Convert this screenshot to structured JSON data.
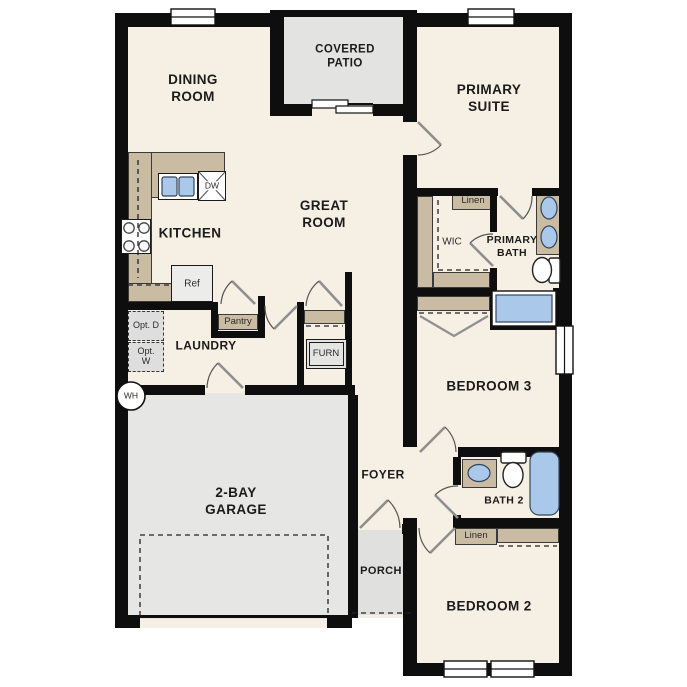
{
  "plan": {
    "rooms": {
      "dining_room": "DINING ROOM",
      "covered_patio": "COVERED PATIO",
      "primary_suite": "PRIMARY SUITE",
      "kitchen": "KITCHEN",
      "great_room": "GREAT ROOM",
      "laundry": "LAUNDRY",
      "garage": "2-BAY GARAGE",
      "foyer": "FOYER",
      "porch": "PORCH",
      "wic": "WIC",
      "primary_bath": "PRIMARY BATH",
      "bedroom_3": "BEDROOM 3",
      "bath_2": "BATH 2",
      "bedroom_2": "BEDROOM 2"
    },
    "labels": {
      "dw": "DW",
      "ref": "Ref",
      "pantry": "Pantry",
      "opt_d": "Opt. D",
      "opt_w": "Opt. W",
      "furn": "FURN",
      "wh": "WH",
      "linen_primary": "Linen",
      "linen_hall": "Linen"
    },
    "colors": {
      "floor": "#f6efe3",
      "outdoor_gray": "#e3e3e2",
      "cabinet_tan": "#c9bca3",
      "fixture_blue": "#aac9ea",
      "wall_black": "#0e0e0e"
    }
  }
}
